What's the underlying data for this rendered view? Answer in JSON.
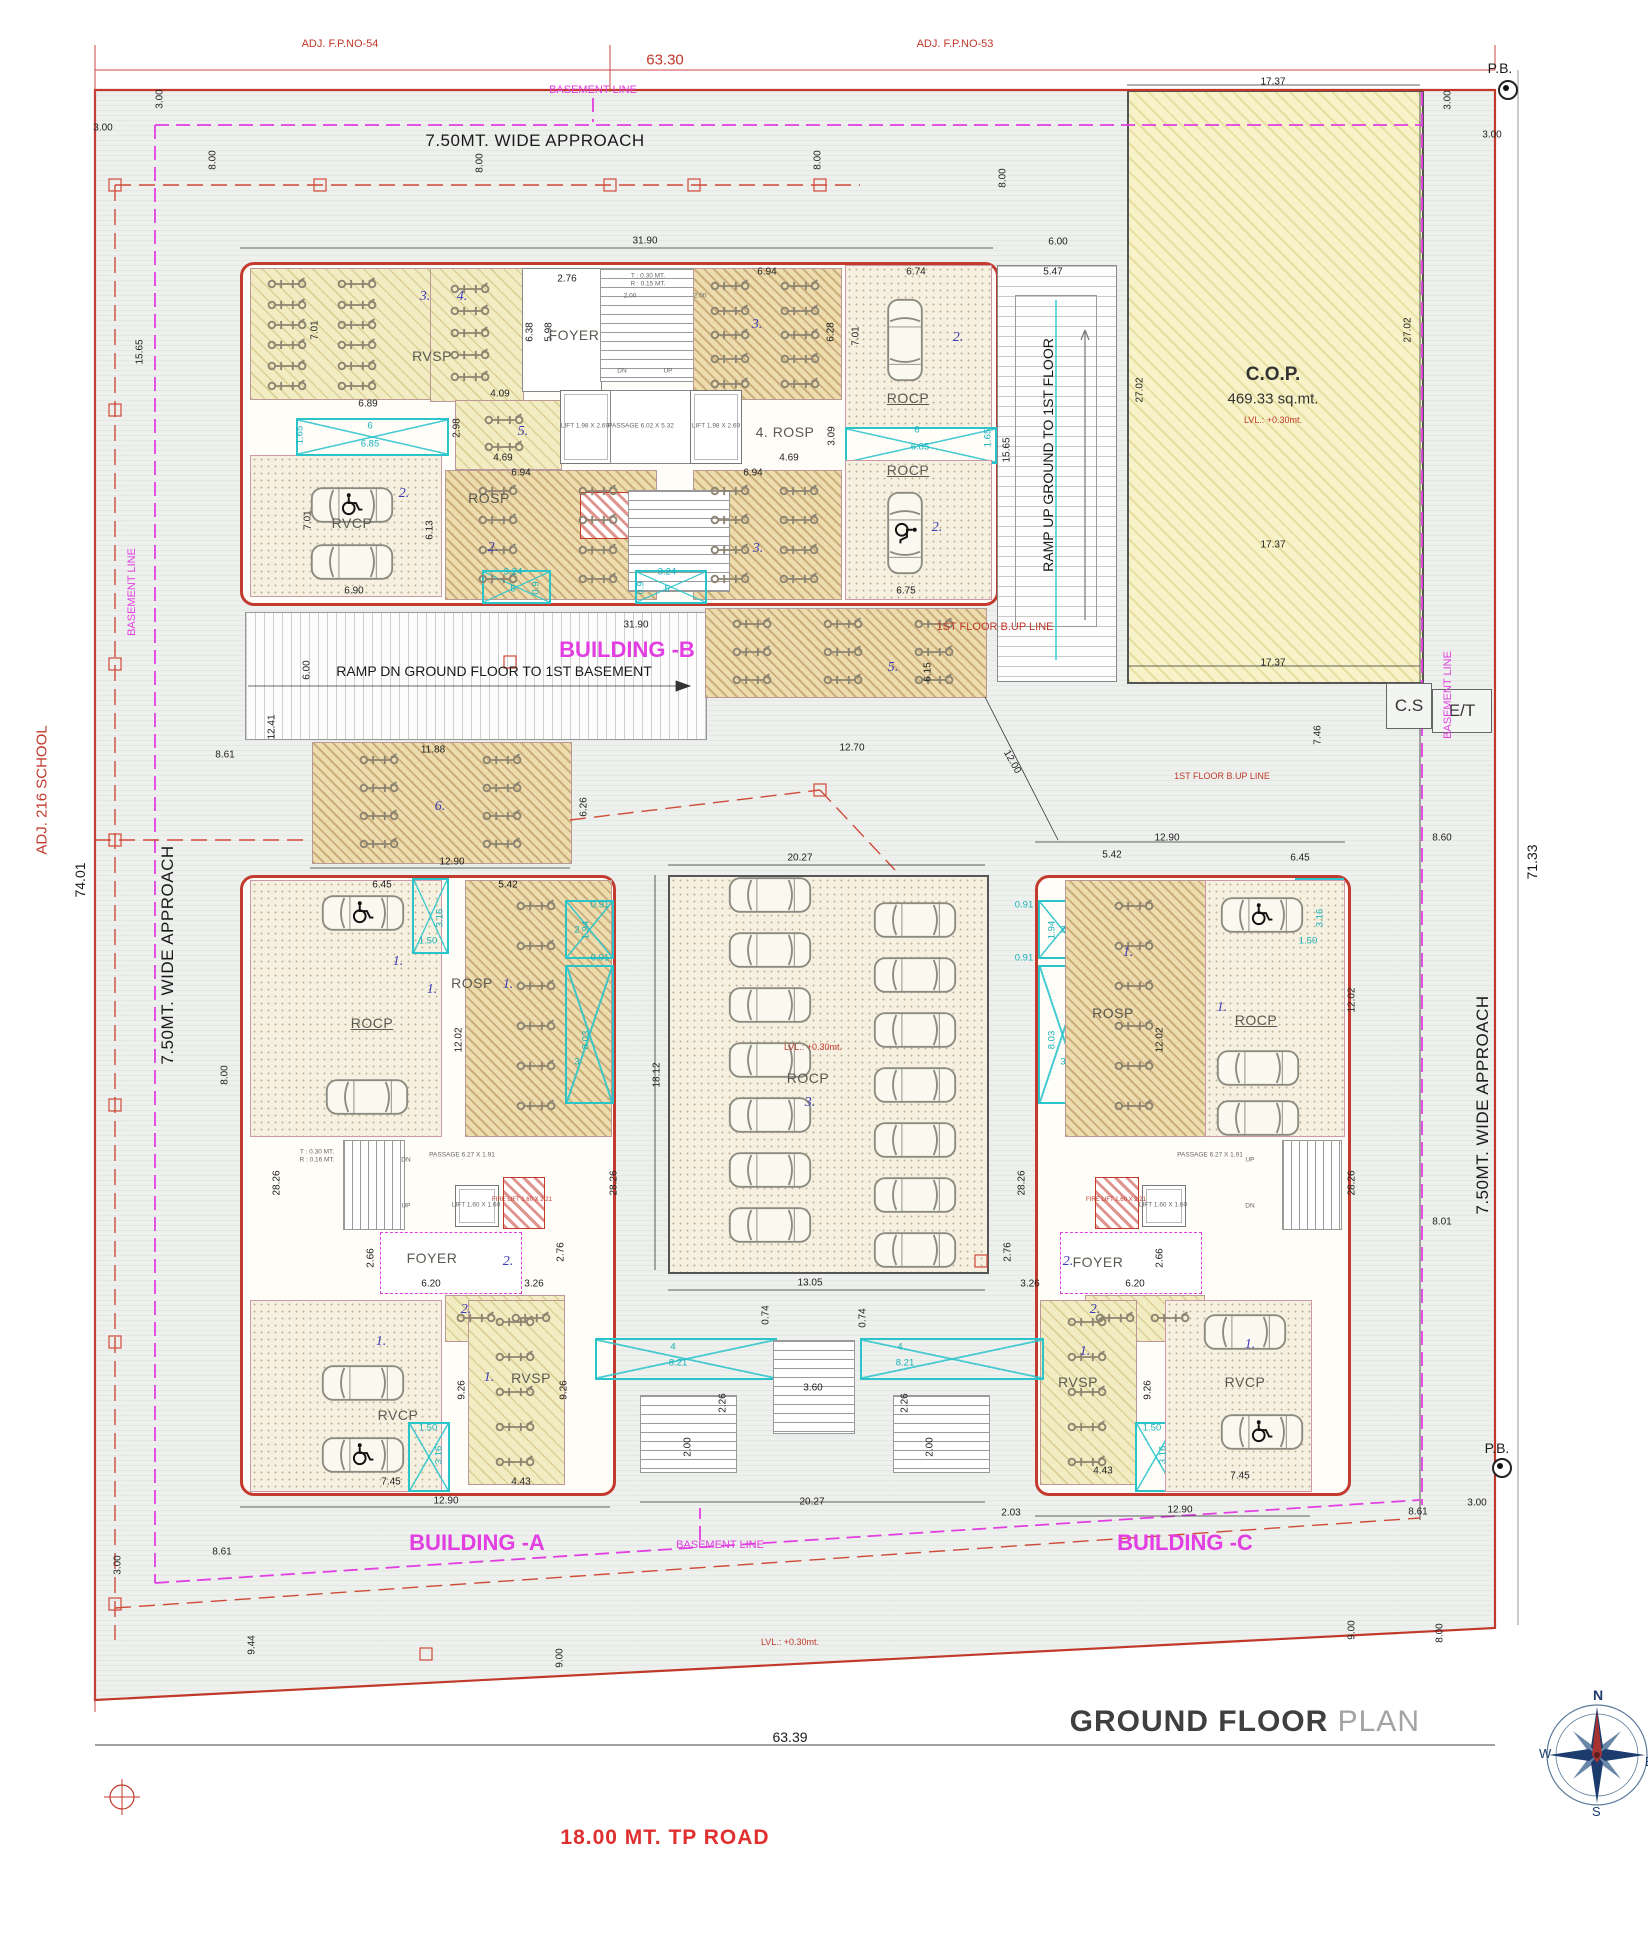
{
  "title": {
    "main": "GROUND FLOOR",
    "sub": " PLAN"
  },
  "road_label": "18.00  MT. TP ROAD",
  "compass": {
    "n": "N",
    "e": "E",
    "s": "S",
    "w": "W"
  },
  "boxes": {
    "cs": "C.S",
    "et": "E/T"
  },
  "cop": {
    "name": "C.O.P.",
    "area": "469.33 sq.mt.",
    "level": "LVL.: +0.30mt."
  },
  "annotations": [
    [
      "ADJ. F.P.NO-54",
      340,
      44,
      0,
      "red"
    ],
    [
      "63.30",
      665,
      60,
      0,
      "redlg"
    ],
    [
      "ADJ. F.P.NO-53",
      955,
      44,
      0,
      "red"
    ],
    [
      "P.B.",
      1500,
      68,
      0,
      "blklg"
    ],
    [
      "BASEMENT LINE",
      593,
      90,
      0,
      "mag"
    ],
    [
      "7.50MT. WIDE APPROACH",
      535,
      141,
      0,
      "blkxl"
    ],
    [
      "3.00",
      160,
      99,
      -90,
      "d"
    ],
    [
      "3.00",
      103,
      128,
      0,
      "d"
    ],
    [
      "8.00",
      213,
      160,
      -90,
      "d"
    ],
    [
      "8.00",
      480,
      163,
      -90,
      "d"
    ],
    [
      "8.00",
      818,
      160,
      -90,
      "d"
    ],
    [
      "8.00",
      1003,
      178,
      -90,
      "d"
    ],
    [
      "31.90",
      645,
      241,
      0,
      "d"
    ],
    [
      "6.00",
      1058,
      242,
      0,
      "d"
    ],
    [
      "5.47",
      1053,
      272,
      0,
      "d"
    ],
    [
      "17.37",
      1273,
      82,
      0,
      "d"
    ],
    [
      "3.00",
      1448,
      100,
      -90,
      "d"
    ],
    [
      "3.00",
      1492,
      135,
      0,
      "d"
    ],
    [
      "27.02",
      1140,
      390,
      -90,
      "d"
    ],
    [
      "27.02",
      1408,
      330,
      -90,
      "d"
    ],
    [
      "17.37",
      1273,
      545,
      0,
      "d"
    ],
    [
      "17.37",
      1273,
      663,
      0,
      "d"
    ],
    [
      "7.46",
      1318,
      735,
      -90,
      "d"
    ],
    [
      "1ST FLOOR B.UP LINE",
      995,
      627,
      0,
      "red"
    ],
    [
      "1ST FLOOR B.UP LINE",
      1222,
      776,
      0,
      "redsm"
    ],
    [
      "BASEMENT LINE",
      1448,
      695,
      -90,
      "mag"
    ],
    [
      "71.33",
      1532,
      862,
      -90,
      "blklg"
    ],
    [
      "7.50MT. WIDE APPROACH",
      1483,
      1105,
      -90,
      "blkxl"
    ],
    [
      "ADJ. 216 SCHOOL",
      42,
      790,
      -90,
      "redlg"
    ],
    [
      "74.01",
      80,
      880,
      -90,
      "blklg"
    ],
    [
      "7.50MT. WIDE APPROACH",
      168,
      955,
      -90,
      "blkxl"
    ],
    [
      "BASEMENT LINE",
      132,
      592,
      -90,
      "mag"
    ],
    [
      "15.65",
      140,
      352,
      -90,
      "d"
    ],
    [
      "RAMP UP GROUND TO 1ST FLOOR",
      1048,
      455,
      -90,
      "blklg"
    ],
    [
      "15.65",
      1007,
      450,
      -90,
      "d"
    ],
    [
      "1.65",
      988,
      438,
      -90,
      "cyan"
    ],
    [
      "12.00",
      1012,
      762,
      60,
      "d"
    ],
    [
      "12.41",
      272,
      727,
      -90,
      "d"
    ],
    [
      "6.00",
      307,
      670,
      -90,
      "d"
    ],
    [
      "31.90",
      636,
      625,
      0,
      "d"
    ],
    [
      "BUILDING -B",
      627,
      650,
      0,
      "magbig"
    ],
    [
      "RAMP DN  GROUND FLOOR TO 1ST BASEMENT",
      494,
      671,
      0,
      "blklg"
    ],
    [
      "11.88",
      433,
      750,
      0,
      "d"
    ],
    [
      "6.",
      440,
      807,
      0,
      "zone"
    ],
    [
      "12.90",
      452,
      862,
      0,
      "d"
    ],
    [
      "6.26",
      584,
      807,
      -90,
      "d"
    ],
    [
      "8.61",
      225,
      755,
      0,
      "d"
    ],
    [
      "12.70",
      852,
      748,
      0,
      "d"
    ],
    [
      "5.",
      893,
      668,
      0,
      "zone"
    ],
    [
      "6.15",
      928,
      672,
      -90,
      "d"
    ],
    [
      "8.00",
      225,
      1075,
      -90,
      "d"
    ],
    [
      "3.",
      425,
      297,
      0,
      "zone"
    ],
    [
      "4.",
      462,
      297,
      0,
      "zone"
    ],
    [
      "RVSP",
      432,
      356,
      0,
      "room"
    ],
    [
      "7.01",
      315,
      330,
      -90,
      "d"
    ],
    [
      "6.89",
      368,
      404,
      0,
      "d"
    ],
    [
      "4.09",
      500,
      394,
      0,
      "d"
    ],
    [
      "6",
      370,
      426,
      0,
      "cyan"
    ],
    [
      "6.85",
      370,
      444,
      0,
      "cyan"
    ],
    [
      "1.65",
      300,
      435,
      -90,
      "cyan"
    ],
    [
      "2.76",
      567,
      279,
      0,
      "d"
    ],
    [
      "5.98",
      549,
      332,
      -90,
      "d"
    ],
    [
      "6.38",
      530,
      332,
      -90,
      "d"
    ],
    [
      "FOYER",
      574,
      335,
      0,
      "room"
    ],
    [
      "2.00",
      630,
      296,
      0,
      "tiny"
    ],
    [
      "2.00",
      700,
      296,
      0,
      "tiny"
    ],
    [
      "T : 0.30 MT.",
      648,
      276,
      0,
      "tiny"
    ],
    [
      "R : 0.15 MT.",
      648,
      284,
      0,
      "tiny"
    ],
    [
      "DN",
      622,
      371,
      0,
      "tiny"
    ],
    [
      "UP",
      668,
      371,
      0,
      "tiny"
    ],
    [
      "LIFT 1.98 X 2.69",
      585,
      426,
      0,
      "tiny"
    ],
    [
      "PASSAGE 6.02 X 5.32",
      641,
      426,
      0,
      "tiny"
    ],
    [
      "LIFT 1.98 X 2.69",
      716,
      426,
      0,
      "tiny"
    ],
    [
      "3.",
      757,
      325,
      0,
      "zone"
    ],
    [
      "6.94",
      767,
      272,
      0,
      "d"
    ],
    [
      "6.28",
      831,
      332,
      -90,
      "d"
    ],
    [
      "6.74",
      916,
      272,
      0,
      "d"
    ],
    [
      "7.01",
      856,
      336,
      -90,
      "d"
    ],
    [
      "2.",
      958,
      338,
      0,
      "zone"
    ],
    [
      "ROCP",
      908,
      398,
      0,
      "roomul"
    ],
    [
      "6",
      917,
      430,
      0,
      "cyan"
    ],
    [
      "6.85",
      920,
      447,
      0,
      "cyan"
    ],
    [
      "ROCP",
      908,
      470,
      0,
      "roomul"
    ],
    [
      "2.",
      937,
      528,
      0,
      "zone"
    ],
    [
      "6.75",
      906,
      591,
      0,
      "d"
    ],
    [
      "5.",
      523,
      432,
      0,
      "zone"
    ],
    [
      "2.98",
      457,
      428,
      -90,
      "d"
    ],
    [
      "4.69",
      503,
      458,
      0,
      "d"
    ],
    [
      "ROSP",
      489,
      498,
      0,
      "room"
    ],
    [
      "6.94",
      521,
      473,
      0,
      "d"
    ],
    [
      "6.13",
      430,
      530,
      -90,
      "d"
    ],
    [
      "2.",
      493,
      548,
      0,
      "zone"
    ],
    [
      "4. ROSP",
      785,
      432,
      0,
      "room"
    ],
    [
      "3.09",
      832,
      436,
      -90,
      "d"
    ],
    [
      "4.69",
      789,
      458,
      0,
      "d"
    ],
    [
      "6.94",
      753,
      473,
      0,
      "d"
    ],
    [
      "3.",
      758,
      549,
      0,
      "zone"
    ],
    [
      "3.24",
      513,
      572,
      0,
      "cyan"
    ],
    [
      "5",
      513,
      589,
      0,
      "cyan"
    ],
    [
      "0.9",
      536,
      588,
      -90,
      "cyan"
    ],
    [
      "3.24",
      667,
      572,
      0,
      "cyan"
    ],
    [
      "5",
      667,
      589,
      0,
      "cyan"
    ],
    [
      "0.9",
      641,
      588,
      -90,
      "cyan"
    ],
    [
      "RVCP",
      352,
      523,
      0,
      "room"
    ],
    [
      "2.",
      404,
      494,
      0,
      "zone"
    ],
    [
      "7.01",
      308,
      520,
      -90,
      "d"
    ],
    [
      "6.90",
      354,
      591,
      0,
      "d"
    ],
    [
      "20.27",
      800,
      858,
      0,
      "d"
    ],
    [
      "18.12",
      657,
      1075,
      -90,
      "d"
    ],
    [
      "LVL.: +0.30mt.",
      813,
      1047,
      0,
      "redsm"
    ],
    [
      "ROCP",
      808,
      1078,
      0,
      "room"
    ],
    [
      "3.",
      810,
      1103,
      0,
      "zone"
    ],
    [
      "13.05",
      810,
      1283,
      0,
      "d"
    ],
    [
      "0.74",
      766,
      1315,
      -90,
      "d"
    ],
    [
      "0.74",
      863,
      1318,
      -90,
      "d"
    ],
    [
      "4",
      673,
      1347,
      0,
      "cyan"
    ],
    [
      "8.21",
      678,
      1363,
      0,
      "cyan"
    ],
    [
      "4",
      900,
      1347,
      0,
      "cyan"
    ],
    [
      "8.21",
      905,
      1363,
      0,
      "cyan"
    ],
    [
      "3.60",
      813,
      1388,
      0,
      "d"
    ],
    [
      "2.26",
      723,
      1403,
      -90,
      "d"
    ],
    [
      "2.26",
      905,
      1403,
      -90,
      "d"
    ],
    [
      "2.00",
      688,
      1447,
      -90,
      "d"
    ],
    [
      "2.00",
      930,
      1447,
      -90,
      "d"
    ],
    [
      "20.27",
      812,
      1502,
      0,
      "d"
    ],
    [
      "BASEMENT LINE",
      720,
      1545,
      0,
      "mag"
    ],
    [
      "LVL.: +0.30mt.",
      790,
      1642,
      0,
      "redsm"
    ],
    [
      "9.00",
      560,
      1658,
      -90,
      "d"
    ],
    [
      "9.44",
      252,
      1645,
      -90,
      "d"
    ],
    [
      "3.00",
      118,
      1565,
      -90,
      "d"
    ],
    [
      "8.61",
      222,
      1552,
      0,
      "d"
    ],
    [
      "63.39",
      790,
      1737,
      0,
      "blklg"
    ],
    [
      "6.45",
      382,
      885,
      0,
      "d"
    ],
    [
      "5.42",
      508,
      885,
      0,
      "d"
    ],
    [
      "1.",
      398,
      962,
      0,
      "zone"
    ],
    [
      "3.16",
      440,
      918,
      -90,
      "cyan"
    ],
    [
      "1.50",
      428,
      941,
      0,
      "cyan"
    ],
    [
      "ROCP",
      372,
      1023,
      0,
      "roomul"
    ],
    [
      "1.",
      432,
      990,
      0,
      "zone"
    ],
    [
      "12.02",
      459,
      1040,
      -90,
      "d"
    ],
    [
      "ROSP",
      472,
      983,
      0,
      "room"
    ],
    [
      "1.",
      508,
      985,
      0,
      "zone"
    ],
    [
      "0.91",
      600,
      905,
      0,
      "cyan"
    ],
    [
      "1.94",
      586,
      930,
      -90,
      "cyan"
    ],
    [
      "0.91",
      600,
      958,
      0,
      "cyan"
    ],
    [
      "2",
      577,
      930,
      0,
      "cyan"
    ],
    [
      "8.03",
      586,
      1040,
      -90,
      "cyan"
    ],
    [
      "3",
      577,
      1062,
      0,
      "cyan"
    ],
    [
      "28.26",
      277,
      1183,
      -90,
      "d"
    ],
    [
      "28.26",
      614,
      1183,
      -90,
      "d"
    ],
    [
      "PASSAGE 6.27 X 1.91",
      462,
      1155,
      0,
      "tiny"
    ],
    [
      "LIFT 1.60 X 1.60",
      476,
      1205,
      0,
      "tiny"
    ],
    [
      "FIRE LIFT 1.60 X 2.21",
      522,
      1200,
      0,
      "tinyred"
    ],
    [
      "DN",
      406,
      1160,
      0,
      "tiny"
    ],
    [
      "UP",
      406,
      1206,
      0,
      "tiny"
    ],
    [
      "T : 0.30 MT.",
      317,
      1152,
      0,
      "tiny"
    ],
    [
      "R : 0.16 MT.",
      317,
      1160,
      0,
      "tiny"
    ],
    [
      "FOYER",
      432,
      1258,
      0,
      "room"
    ],
    [
      "2.66",
      371,
      1258,
      -90,
      "d"
    ],
    [
      "6.20",
      431,
      1284,
      0,
      "d"
    ],
    [
      "2.",
      508,
      1262,
      0,
      "zone"
    ],
    [
      "3.26",
      534,
      1284,
      0,
      "d"
    ],
    [
      "2.76",
      561,
      1252,
      -90,
      "d"
    ],
    [
      "1.",
      381,
      1342,
      0,
      "zone"
    ],
    [
      "RVCP",
      398,
      1415,
      0,
      "room"
    ],
    [
      "7.45",
      391,
      1482,
      0,
      "d"
    ],
    [
      "1.50",
      428,
      1428,
      0,
      "cyan"
    ],
    [
      "3.16",
      439,
      1455,
      -90,
      "cyan"
    ],
    [
      "1.",
      489,
      1378,
      0,
      "zone"
    ],
    [
      "RVSP",
      531,
      1378,
      0,
      "room"
    ],
    [
      "9.26",
      462,
      1390,
      -90,
      "d"
    ],
    [
      "9.26",
      564,
      1390,
      -90,
      "d"
    ],
    [
      "4.43",
      521,
      1482,
      0,
      "d"
    ],
    [
      "12.90",
      446,
      1501,
      0,
      "d"
    ],
    [
      "BUILDING -A",
      477,
      1543,
      0,
      "magbig"
    ],
    [
      "2.",
      466,
      1310,
      0,
      "zone"
    ],
    [
      "12.90",
      1167,
      838,
      0,
      "d"
    ],
    [
      "8.60",
      1442,
      838,
      0,
      "d"
    ],
    [
      "5.42",
      1112,
      855,
      0,
      "d"
    ],
    [
      "6.45",
      1300,
      858,
      0,
      "d"
    ],
    [
      "0.91",
      1024,
      905,
      0,
      "cyan"
    ],
    [
      "1.94",
      1052,
      930,
      -90,
      "cyan"
    ],
    [
      "0.91",
      1024,
      958,
      0,
      "cyan"
    ],
    [
      "2",
      1063,
      930,
      0,
      "cyan"
    ],
    [
      "8.03",
      1052,
      1040,
      -90,
      "cyan"
    ],
    [
      "3",
      1063,
      1062,
      0,
      "cyan"
    ],
    [
      "1.",
      1128,
      953,
      0,
      "zone"
    ],
    [
      "ROSP",
      1113,
      1013,
      0,
      "room"
    ],
    [
      "12.02",
      1160,
      1040,
      -90,
      "d"
    ],
    [
      "1.",
      1222,
      1008,
      0,
      "zone"
    ],
    [
      "ROCP",
      1256,
      1020,
      0,
      "roomul"
    ],
    [
      "3.16",
      1320,
      918,
      -90,
      "cyan"
    ],
    [
      "1.50",
      1308,
      941,
      0,
      "cyan"
    ],
    [
      "12.02",
      1352,
      1000,
      -90,
      "d"
    ],
    [
      "28.26",
      1022,
      1183,
      -90,
      "d"
    ],
    [
      "28.26",
      1352,
      1183,
      -90,
      "d"
    ],
    [
      "8.01",
      1442,
      1222,
      0,
      "d"
    ],
    [
      "PASSAGE 6.27 X 1.91",
      1210,
      1155,
      0,
      "tiny"
    ],
    [
      "LIFT 1.60 X 1.60",
      1163,
      1205,
      0,
      "tiny"
    ],
    [
      "FIRE LIFT 1.60 X 2.21",
      1116,
      1200,
      0,
      "tinyred"
    ],
    [
      "UP",
      1250,
      1160,
      0,
      "tiny"
    ],
    [
      "DN",
      1250,
      1206,
      0,
      "tiny"
    ],
    [
      "FOYER",
      1098,
      1262,
      0,
      "room"
    ],
    [
      "2.66",
      1160,
      1258,
      -90,
      "d"
    ],
    [
      "6.20",
      1135,
      1284,
      0,
      "d"
    ],
    [
      "2.",
      1068,
      1262,
      0,
      "zone"
    ],
    [
      "3.26",
      1030,
      1284,
      0,
      "d"
    ],
    [
      "2.76",
      1008,
      1252,
      -90,
      "d"
    ],
    [
      "2.",
      1095,
      1310,
      0,
      "zone"
    ],
    [
      "1.",
      1085,
      1352,
      0,
      "zone"
    ],
    [
      "RVSP",
      1078,
      1382,
      0,
      "room"
    ],
    [
      "9.26",
      1148,
      1390,
      -90,
      "d"
    ],
    [
      "4.43",
      1103,
      1471,
      0,
      "d"
    ],
    [
      "1.50",
      1152,
      1428,
      0,
      "cyan"
    ],
    [
      "3.16",
      1163,
      1455,
      -90,
      "cyan"
    ],
    [
      "1.",
      1250,
      1345,
      0,
      "zone"
    ],
    [
      "RVCP",
      1245,
      1382,
      0,
      "room"
    ],
    [
      "7.45",
      1240,
      1476,
      0,
      "d"
    ],
    [
      "12.90",
      1180,
      1510,
      0,
      "d"
    ],
    [
      "2.03",
      1011,
      1513,
      0,
      "d"
    ],
    [
      "8.61",
      1418,
      1512,
      0,
      "d"
    ],
    [
      "3.00",
      1477,
      1503,
      0,
      "d"
    ],
    [
      "P.B.",
      1497,
      1448,
      0,
      "blklg"
    ],
    [
      "BUILDING -C",
      1185,
      1543,
      0,
      "magbig"
    ],
    [
      "9.00",
      1352,
      1630,
      -90,
      "d"
    ],
    [
      "8.00",
      1440,
      1633,
      -90,
      "d"
    ]
  ],
  "cars": [
    [
      905,
      340,
      90,
      false
    ],
    [
      905,
      533,
      90,
      true
    ],
    [
      352,
      505,
      0,
      true
    ],
    [
      352,
      562,
      0,
      false
    ],
    [
      363,
      913,
      0,
      true
    ],
    [
      367,
      1097,
      0,
      false
    ],
    [
      363,
      1383,
      0,
      false
    ],
    [
      363,
      1455,
      0,
      true
    ],
    [
      1262,
      915,
      0,
      true
    ],
    [
      1258,
      1068,
      0,
      false
    ],
    [
      1258,
      1118,
      0,
      false
    ],
    [
      1245,
      1332,
      0,
      false
    ],
    [
      1262,
      1432,
      0,
      true
    ],
    [
      770,
      895,
      0,
      false
    ],
    [
      770,
      950,
      0,
      false
    ],
    [
      770,
      1005,
      0,
      false
    ],
    [
      770,
      1060,
      0,
      false
    ],
    [
      770,
      1115,
      0,
      false
    ],
    [
      770,
      1170,
      0,
      false
    ],
    [
      770,
      1225,
      0,
      false
    ],
    [
      915,
      920,
      0,
      false
    ],
    [
      915,
      975,
      0,
      false
    ],
    [
      915,
      1030,
      0,
      false
    ],
    [
      915,
      1085,
      0,
      false
    ],
    [
      915,
      1140,
      0,
      false
    ],
    [
      915,
      1195,
      0,
      false
    ],
    [
      915,
      1250,
      0,
      false
    ]
  ],
  "scooter_zones": [
    [
      252,
      274,
      140,
      122,
      6,
      2
    ],
    [
      434,
      278,
      72,
      110,
      5,
      1
    ],
    [
      695,
      274,
      140,
      122,
      5,
      2
    ],
    [
      458,
      406,
      92,
      54,
      2,
      1
    ],
    [
      448,
      476,
      200,
      118,
      4,
      2
    ],
    [
      695,
      476,
      138,
      118,
      4,
      2
    ],
    [
      707,
      610,
      272,
      84,
      3,
      3
    ],
    [
      317,
      746,
      246,
      112,
      4,
      2
    ],
    [
      470,
      886,
      132,
      240,
      6,
      1
    ],
    [
      448,
      1298,
      110,
      40,
      1,
      2
    ],
    [
      470,
      1304,
      90,
      175,
      5,
      1
    ],
    [
      1068,
      886,
      132,
      240,
      6,
      1
    ],
    [
      1087,
      1298,
      110,
      40,
      1,
      2
    ],
    [
      1042,
      1304,
      90,
      175,
      5,
      1
    ]
  ]
}
